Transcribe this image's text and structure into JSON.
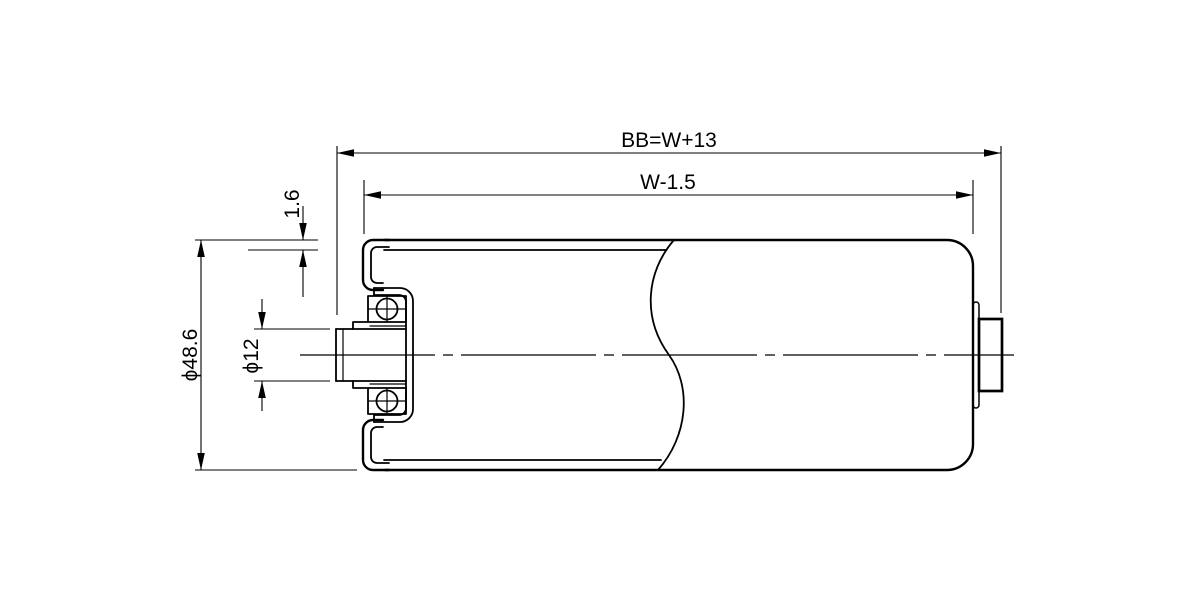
{
  "drawing": {
    "type": "technical-drawing",
    "subject": "conveyor roller cross-section with bearing, shaft and tube",
    "background_color": "#ffffff",
    "line_color": "#000000",
    "labels": {
      "overall_length": "BB=W+13",
      "tube_length": "W-1.5",
      "wall_thickness": "1.6",
      "shaft_diameter": "ϕ12",
      "roller_diameter": "ϕ48.6"
    }
  }
}
